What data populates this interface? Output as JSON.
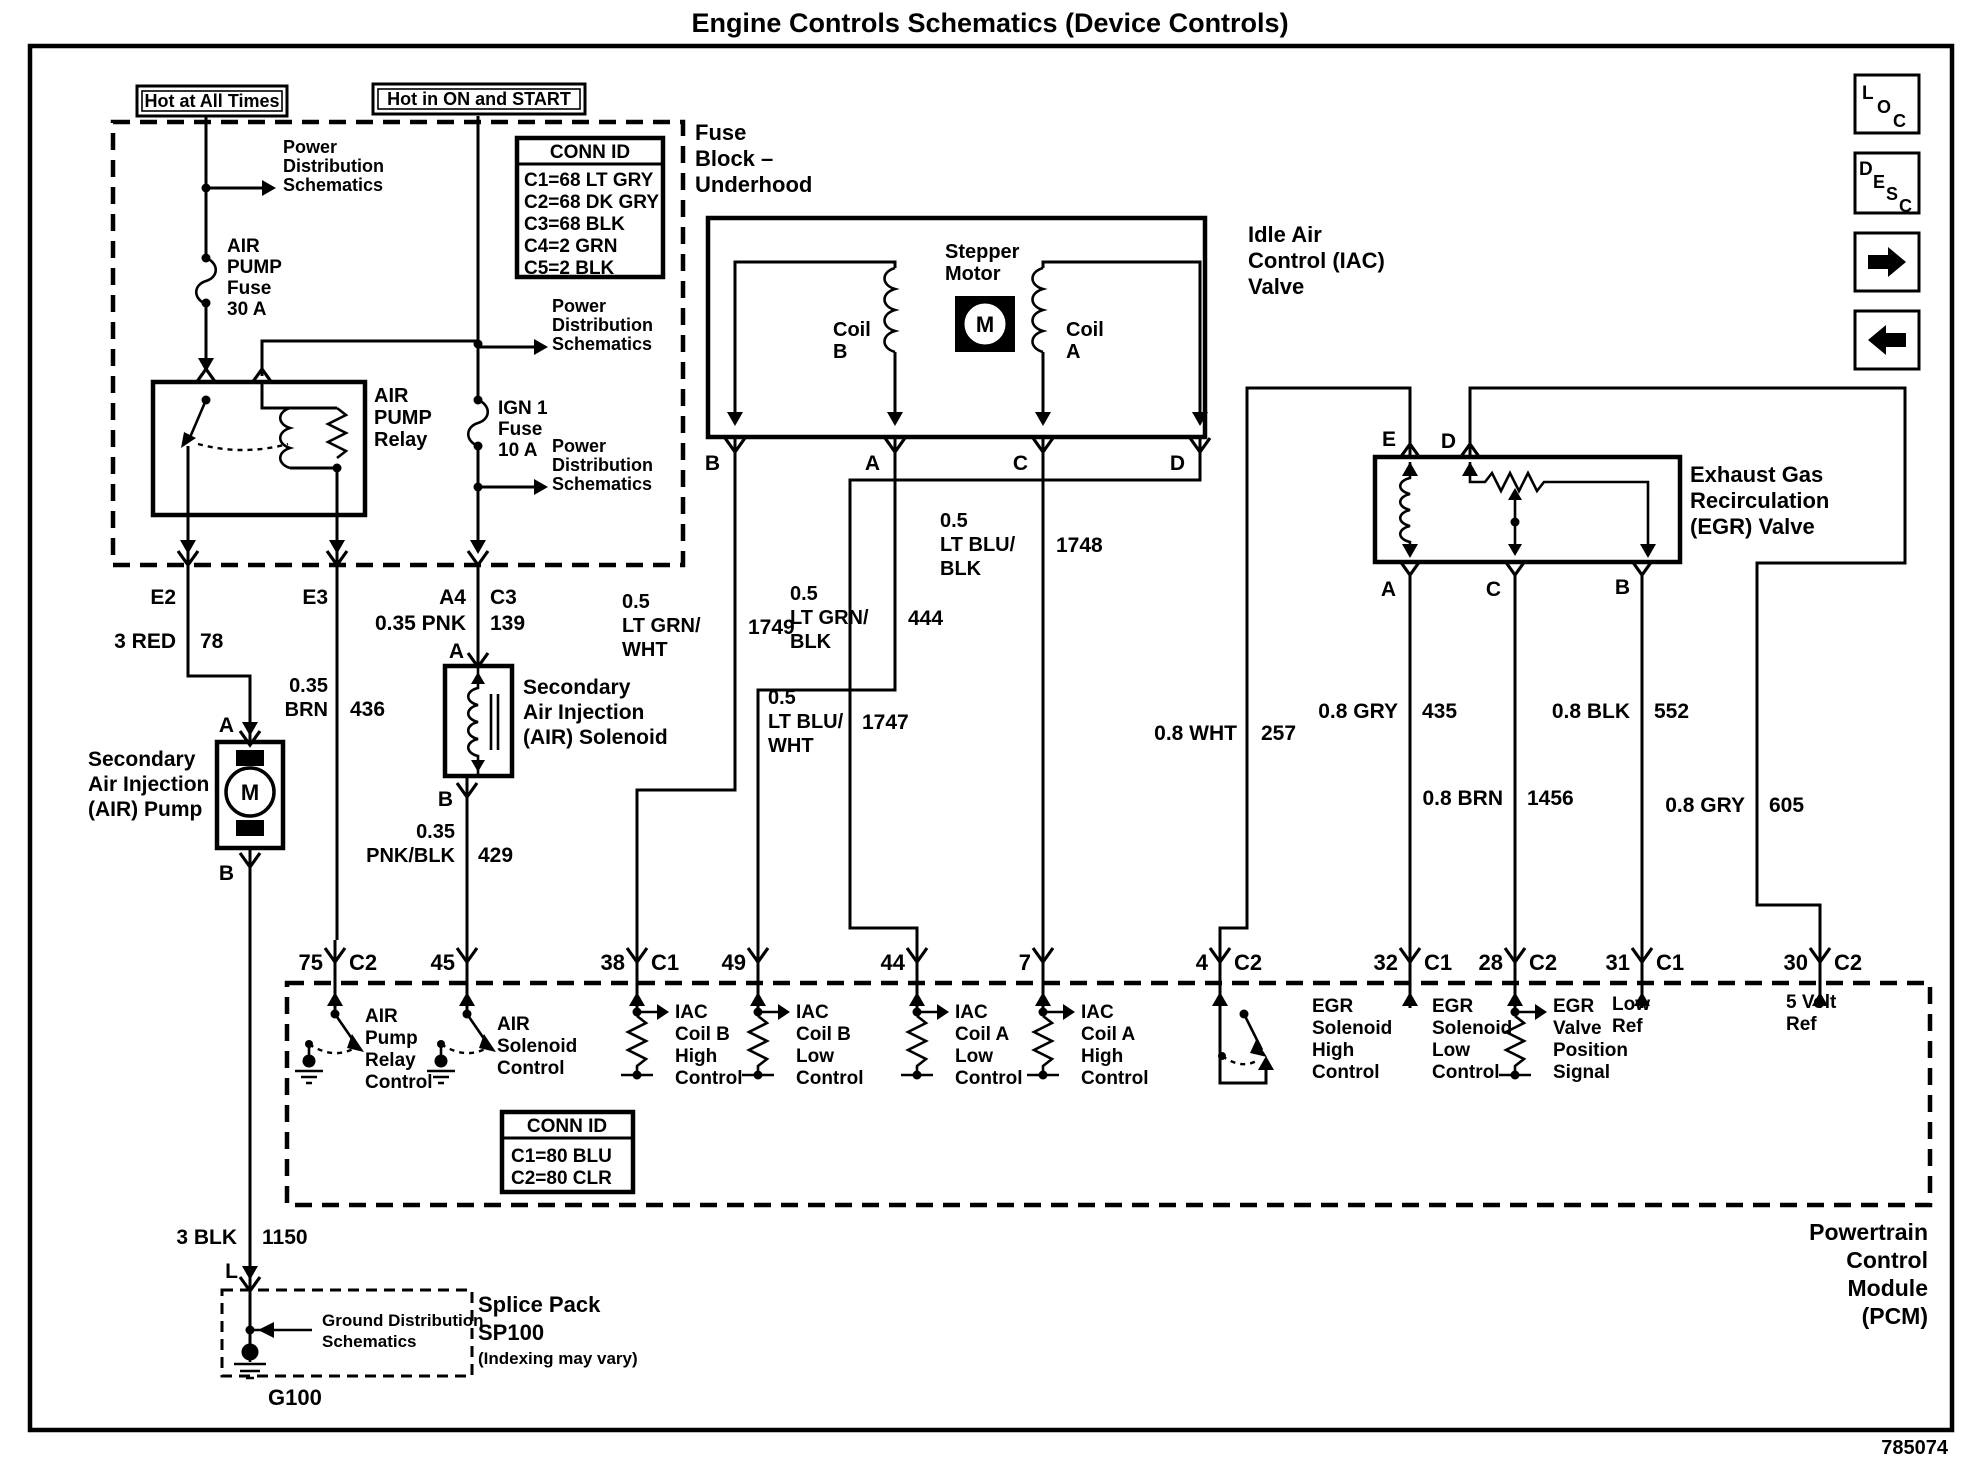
{
  "title": "Engine Controls Schematics (Device Controls)",
  "doc_number": "785074",
  "nav": {
    "loc_letters": [
      "L",
      "O",
      "C"
    ],
    "desc_letters": [
      "D",
      "E",
      "S",
      "C"
    ]
  },
  "banners": {
    "hot_at_all_times": "Hot at All Times",
    "hot_in_on_and_start": "Hot in ON and START"
  },
  "power_distribution_ref": "Power\nDistribution\nSchematics",
  "fuse_block": {
    "label": "Fuse\nBlock –\nUnderhood",
    "conn_id_title": "CONN ID",
    "conn_id_rows": [
      "C1=68 LT GRY",
      "C2=68 DK GRY",
      "C3=68 BLK",
      "C4=2 GRN",
      "C5=2 BLK"
    ],
    "air_pump_fuse": "AIR\nPUMP\nFuse\n30 A",
    "ign1_fuse": "IGN 1\nFuse\n10 A",
    "relay": "AIR\nPUMP\nRelay",
    "pins": {
      "e2": "E2",
      "e3": "E3",
      "a4": "A4",
      "c3": "C3"
    }
  },
  "iac": {
    "label": "Idle Air\nControl (IAC)\nValve",
    "stepper": "Stepper\nMotor",
    "motor": "M",
    "coil_b": "Coil\nB",
    "coil_a": "Coil\nA",
    "pin_b": "B",
    "pin_a": "A",
    "pin_c": "C",
    "pin_d": "D"
  },
  "egr": {
    "label": "Exhaust Gas\nRecirculation\n(EGR) Valve",
    "pin_e": "E",
    "pin_d": "D",
    "pin_a": "A",
    "pin_c": "C",
    "pin_b": "B"
  },
  "air_pump": {
    "label": "Secondary\nAir Injection\n(AIR) Pump",
    "motor": "M",
    "pin_a": "A",
    "pin_b": "B"
  },
  "air_solenoid": {
    "label": "Secondary\nAir Injection\n(AIR) Solenoid",
    "pin_a": "A",
    "pin_b": "B"
  },
  "splice": {
    "label": "Splice Pack",
    "id": "SP100",
    "note": "(Indexing may vary)",
    "ref": "Ground Distribution\nSchematics",
    "ground": "G100",
    "pin": "L"
  },
  "wires": {
    "w78": {
      "gauge_color": "3 RED",
      "circuit": "78"
    },
    "w436": {
      "gauge_color": "0.35\nBRN",
      "circuit": "436"
    },
    "w139": {
      "gauge_color": "0.35 PNK",
      "circuit": "139"
    },
    "w429": {
      "gauge_color": "0.35\nPNK/BLK",
      "circuit": "429"
    },
    "w1749": {
      "gauge_color": "0.5\nLT GRN/\nWHT",
      "circuit": "1749"
    },
    "w444": {
      "gauge_color": "0.5\nLT GRN/\nBLK",
      "circuit": "444"
    },
    "w1748": {
      "gauge_color": "0.5\nLT BLU/\nBLK",
      "circuit": "1748"
    },
    "w1747": {
      "gauge_color": "0.5\nLT BLU/\nWHT",
      "circuit": "1747"
    },
    "w257": {
      "gauge_color": "0.8 WHT",
      "circuit": "257"
    },
    "w435": {
      "gauge_color": "0.8 GRY",
      "circuit": "435"
    },
    "w552": {
      "gauge_color": "0.8 BLK",
      "circuit": "552"
    },
    "w1456": {
      "gauge_color": "0.8 BRN",
      "circuit": "1456"
    },
    "w605": {
      "gauge_color": "0.8 GRY",
      "circuit": "605"
    },
    "w1150": {
      "gauge_color": "3 BLK",
      "circuit": "1150"
    }
  },
  "pcm": {
    "label": "Powertrain\nControl\nModule\n(PCM)",
    "conn_id_title": "CONN ID",
    "conn_id_rows": [
      "C1=80 BLU",
      "C2=80 CLR"
    ],
    "pins": [
      {
        "num": "75",
        "conn": "C2",
        "fn": "AIR\nPump\nRelay\nControl"
      },
      {
        "num": "45",
        "conn": "",
        "fn": "AIR\nSolenoid\nControl"
      },
      {
        "num": "38",
        "conn": "C1",
        "fn": "IAC\nCoil B\nHigh\nControl"
      },
      {
        "num": "49",
        "conn": "",
        "fn": "IAC\nCoil B\nLow\nControl"
      },
      {
        "num": "44",
        "conn": "",
        "fn": "IAC\nCoil A\nLow\nControl"
      },
      {
        "num": "7",
        "conn": "",
        "fn": "IAC\nCoil A\nHigh\nControl"
      },
      {
        "num": "4",
        "conn": "C2",
        "fn": "EGR\nSolenoid\nHigh\nControl"
      },
      {
        "num": "32",
        "conn": "C1",
        "fn": "EGR\nSolenoid\nLow\nControl"
      },
      {
        "num": "28",
        "conn": "C2",
        "fn": "EGR\nValve\nPosition\nSignal"
      },
      {
        "num": "31",
        "conn": "C1",
        "fn": "Low\nRef"
      },
      {
        "num": "30",
        "conn": "C2",
        "fn": "5 Volt\nRef"
      }
    ]
  }
}
